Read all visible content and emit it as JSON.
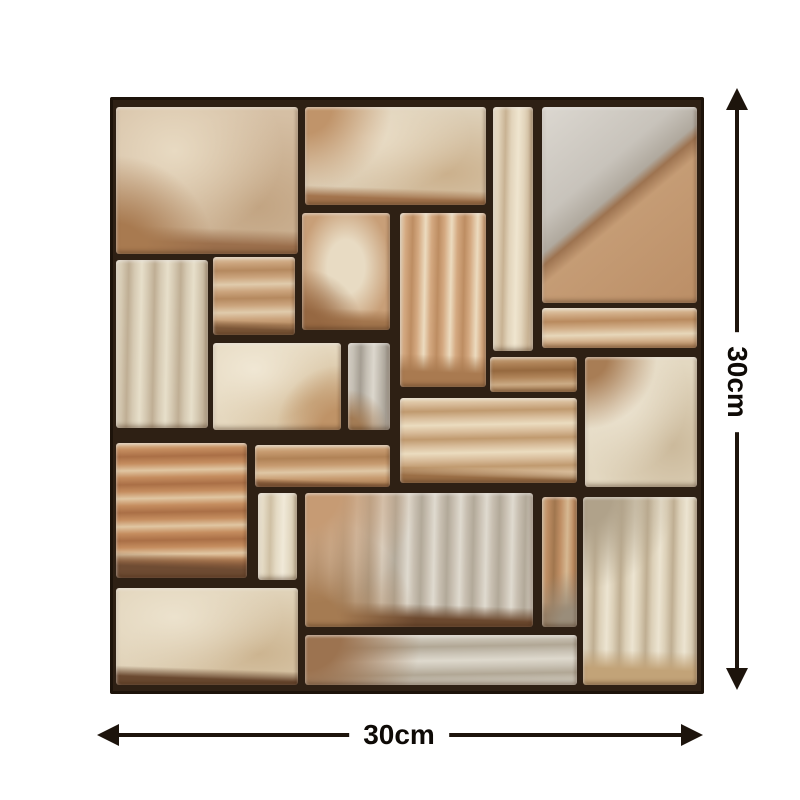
{
  "page": {
    "background": "#ffffff"
  },
  "tile_sticker": {
    "name": "stone-mosaic-wall-tile-sticker",
    "grout_color": "#2e2014",
    "frame_color": "#1f1408",
    "stones": [
      {
        "id": "A",
        "desc": "large-beige-block-top-left",
        "x": 6,
        "y": 10,
        "w": 182,
        "h": 147,
        "texture": "sand",
        "c": {
          "base": "#d5bfa4",
          "light": "#e8dac2",
          "mid": "#c2a482"
        },
        "edges": {
          "bottom": "#9b6f4c"
        },
        "corners": {
          "bl": "#a87a50"
        }
      },
      {
        "id": "B",
        "desc": "wide-cream-block-top",
        "x": 195,
        "y": 10,
        "w": 181,
        "h": 98,
        "texture": "sand",
        "c": {
          "base": "#ddcfb7",
          "light": "#ebdfc9",
          "mid": "#cbb08c"
        },
        "edges": {
          "bottom": "#a3744d"
        },
        "corners": {
          "tl": "#c0946a"
        }
      },
      {
        "id": "N",
        "desc": "narrow-vertical-cream-strip",
        "x": 383,
        "y": 10,
        "w": 40,
        "h": 244,
        "texture": "streak-v",
        "c": {
          "base": "#e2d4bb",
          "light": "#efe5cf",
          "mid": "#c8b293"
        }
      },
      {
        "id": "R",
        "desc": "large-grey-tan-diagonal-block-top-right",
        "x": 432,
        "y": 10,
        "w": 155,
        "h": 196,
        "texture": "diagonal",
        "c": {
          "base": "#c8c3bb",
          "light": "#dcd8d1",
          "mid": "#b0a99e",
          "dark": "#9d7350",
          "tan": "#c59c75",
          "tan2": "#bb8e66"
        }
      },
      {
        "id": "C",
        "desc": "tall-pale-block-left",
        "x": 6,
        "y": 163,
        "w": 92,
        "h": 168,
        "texture": "streak-v",
        "c": {
          "base": "#d6cab3",
          "light": "#e7dfca",
          "mid": "#bfae94"
        }
      },
      {
        "id": "D",
        "desc": "small-square-tan-block",
        "x": 103,
        "y": 160,
        "w": 82,
        "h": 78,
        "texture": "streak-h",
        "c": {
          "base": "#cba47d",
          "light": "#e0cbac",
          "mid": "#b5895f"
        },
        "edges": {
          "bottom": "#7d5839"
        }
      },
      {
        "id": "F1",
        "desc": "square-block-light-center",
        "x": 192,
        "y": 116,
        "w": 88,
        "h": 117,
        "texture": "center",
        "c": {
          "base": "#c89f78",
          "light": "#e8dbc3",
          "mid": "#b98e63"
        },
        "edges": {
          "bottom": "#a3764e"
        },
        "corners": {
          "bl": "#966842"
        }
      },
      {
        "id": "F2",
        "desc": "tall-rose-streak-block",
        "x": 290,
        "y": 116,
        "w": 86,
        "h": 174,
        "texture": "streak-v",
        "c": {
          "base": "#d4a981",
          "light": "#ecdbbf",
          "mid": "#bd8d62"
        },
        "edges": {
          "bottom": "#a97a50"
        }
      },
      {
        "id": "W",
        "desc": "wide-short-tan-block-right",
        "x": 432,
        "y": 211,
        "w": 155,
        "h": 40,
        "texture": "streak-h",
        "c": {
          "base": "#d1ad87",
          "light": "#e7d7ba",
          "mid": "#b98a5e"
        }
      },
      {
        "id": "E",
        "desc": "cream-block-middle",
        "x": 103,
        "y": 246,
        "w": 128,
        "h": 87,
        "texture": "sand",
        "c": {
          "base": "#e5d8bf",
          "light": "#f0e7d4",
          "mid": "#d1b791"
        },
        "corners": {
          "br": "#bf9367"
        }
      },
      {
        "id": "G",
        "desc": "narrow-grey-strip-middle",
        "x": 238,
        "y": 246,
        "w": 42,
        "h": 87,
        "texture": "streak-v",
        "c": {
          "base": "#c4beb3",
          "light": "#dcd7cd",
          "mid": "#a59e93"
        },
        "corners": {
          "bl": "#a37c55"
        }
      },
      {
        "id": "S1",
        "desc": "short-brown-block",
        "x": 380,
        "y": 260,
        "w": 87,
        "h": 35,
        "texture": "streak-h",
        "c": {
          "base": "#b08459",
          "light": "#cbab85",
          "mid": "#96693f"
        }
      },
      {
        "id": "T",
        "desc": "tall-cream-block-right",
        "x": 475,
        "y": 260,
        "w": 112,
        "h": 130,
        "texture": "sand",
        "c": {
          "base": "#e3d8c1",
          "light": "#eee6d4",
          "mid": "#cbb99b"
        },
        "corners": {
          "tl": "#a87d55"
        }
      },
      {
        "id": "M1",
        "desc": "wide-streaked-block-center",
        "x": 290,
        "y": 301,
        "w": 177,
        "h": 85,
        "texture": "streak-h",
        "c": {
          "base": "#d8bc9a",
          "light": "#ebdcbf",
          "mid": "#c09a6f"
        },
        "edges": {
          "bottom": "#9c7047"
        }
      },
      {
        "id": "J",
        "desc": "rosy-orange-block-left",
        "x": 6,
        "y": 346,
        "w": 131,
        "h": 135,
        "texture": "streak-h",
        "c": {
          "base": "#c58d5f",
          "light": "#e0c6a2",
          "mid": "#aa6f46"
        },
        "edges": {
          "bottom": "#6f4c33"
        }
      },
      {
        "id": "H",
        "desc": "tan-chipped-short-block",
        "x": 145,
        "y": 348,
        "w": 135,
        "h": 42,
        "texture": "streak-h",
        "c": {
          "base": "#c79b70",
          "light": "#dfc7a5",
          "mid": "#b08256"
        },
        "edges": {
          "bottom": "#8a5f3e"
        }
      },
      {
        "id": "K",
        "desc": "narrow-cream-strip-lower",
        "x": 148,
        "y": 396,
        "w": 39,
        "h": 87,
        "texture": "streak-v",
        "c": {
          "base": "#e4dac4",
          "light": "#f0e9d8",
          "mid": "#cfc0a4"
        }
      },
      {
        "id": "P",
        "desc": "large-grey-rose-block-lower-center",
        "x": 195,
        "y": 396,
        "w": 228,
        "h": 134,
        "texture": "streak-v",
        "c": {
          "base": "#c8bfb1",
          "light": "#dfdacf",
          "mid": "#b2a999"
        },
        "edges": {
          "bottom": "#6d4a30"
        },
        "corners": {
          "tl": "#c69b74",
          "bl": "#a57b52"
        }
      },
      {
        "id": "U",
        "desc": "narrow-tan-strip-lower-right",
        "x": 432,
        "y": 400,
        "w": 35,
        "h": 130,
        "texture": "streak-v",
        "c": {
          "base": "#bf8e64",
          "light": "#d6b892",
          "mid": "#a0764e"
        },
        "corners": {
          "br": "#9a8d7a"
        },
        "edges": {
          "bottom": "#8d6845"
        }
      },
      {
        "id": "V",
        "desc": "tall-sandy-block-bottom-right",
        "x": 473,
        "y": 400,
        "w": 114,
        "h": 188,
        "texture": "streak-v",
        "c": {
          "base": "#dcd0b8",
          "light": "#ece4d1",
          "mid": "#bfae92"
        },
        "corners": {
          "tl": "#b0a28a"
        },
        "edges": {
          "bottom": "#c2a378"
        }
      },
      {
        "id": "Q",
        "desc": "cream-block-bottom-left",
        "x": 6,
        "y": 491,
        "w": 182,
        "h": 97,
        "texture": "sand",
        "c": {
          "base": "#e0d2b8",
          "light": "#ece2cd",
          "mid": "#ccb490"
        },
        "edges": {
          "bottom": "#6b4a31"
        }
      },
      {
        "id": "Z",
        "desc": "wide-grey-block-bottom",
        "x": 195,
        "y": 538,
        "w": 272,
        "h": 50,
        "texture": "streak-h",
        "c": {
          "base": "#c9c2b4",
          "light": "#ded9cd",
          "mid": "#b1a795"
        },
        "corners": {
          "tl": "#9c7350"
        }
      }
    ]
  },
  "dimensions": {
    "width": {
      "label": "30cm"
    },
    "height": {
      "label": "30cm"
    },
    "arrow_color": "#1d140c",
    "label_color": "#0e0a06"
  }
}
